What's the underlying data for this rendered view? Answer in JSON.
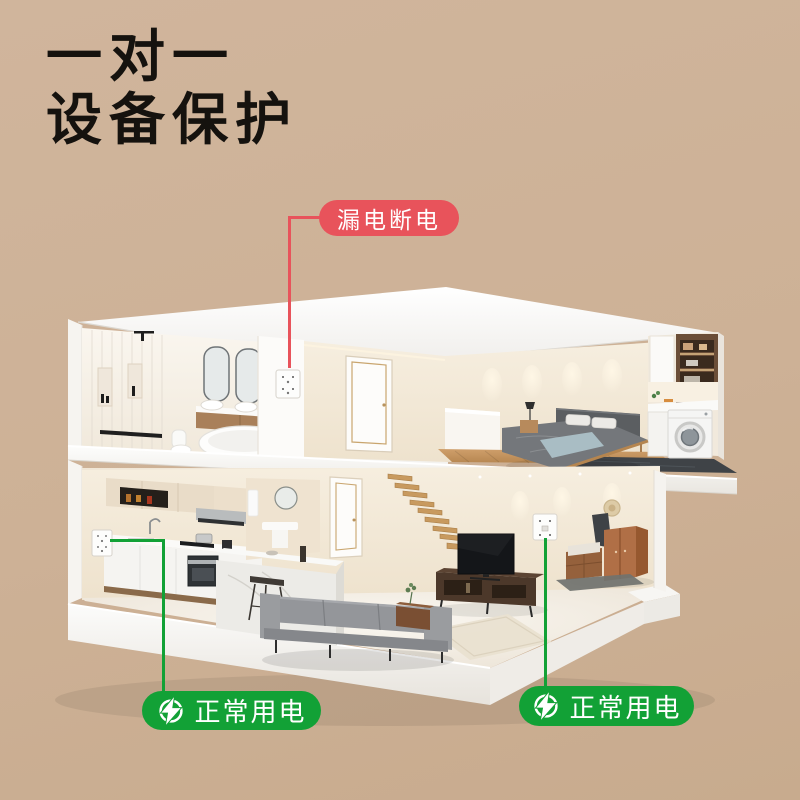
{
  "page": {
    "background_top": "#d0b59c",
    "background_bottom": "#c8ab8e"
  },
  "heading": {
    "line1": "一对一",
    "line2": "设备保护",
    "color": "#15120e"
  },
  "callouts": {
    "leakage": {
      "label": "漏电断电",
      "pill_color": "#e8535b",
      "text_color": "#ffffff",
      "points_to": "bathroom-wall-socket"
    },
    "normal_kitchen": {
      "label": "正常用电",
      "pill_color": "#12a136",
      "text_color": "#ffffff",
      "icon": "lightning-bolt",
      "points_to": "kitchen-wall-socket"
    },
    "normal_living": {
      "label": "正常用电",
      "pill_color": "#12a136",
      "text_color": "#ffffff",
      "icon": "lightning-bolt",
      "points_to": "living-room-wall-socket"
    }
  }
}
